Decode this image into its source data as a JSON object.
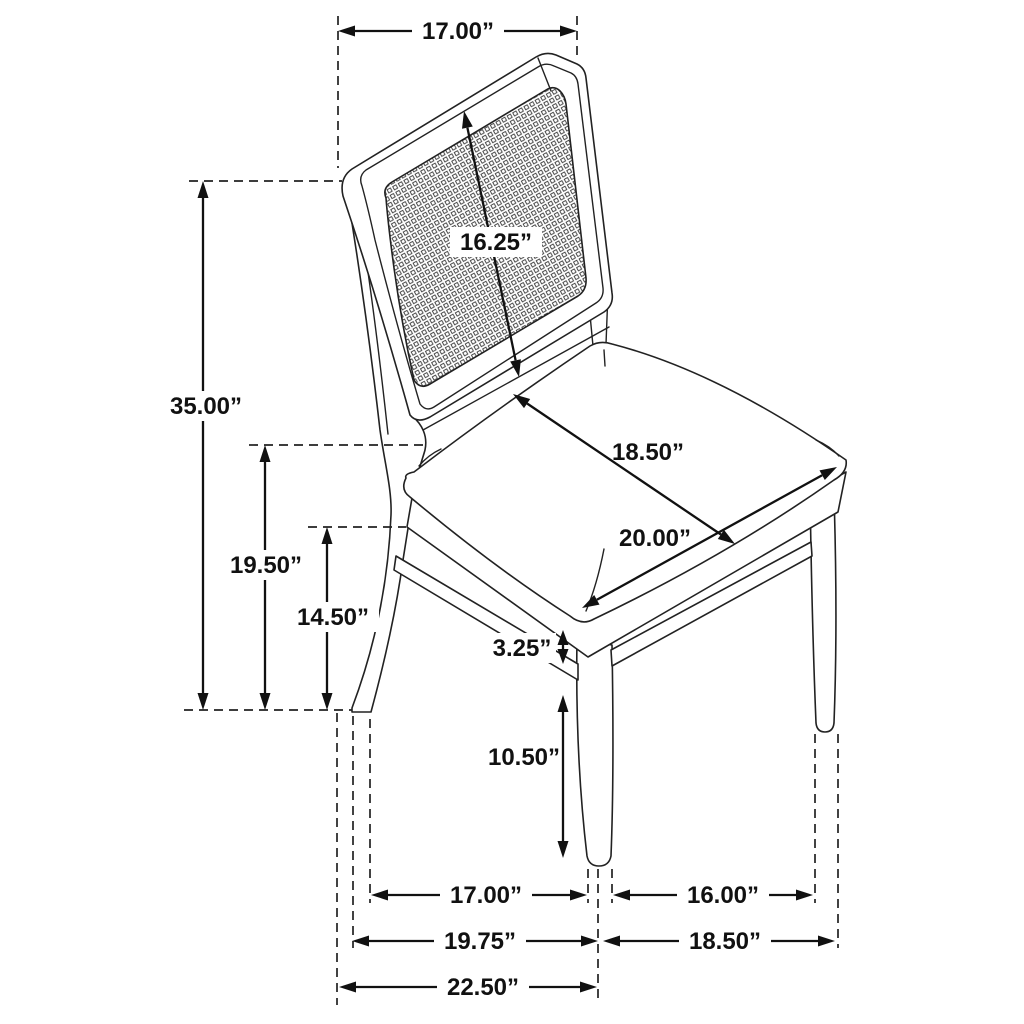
{
  "diagram": {
    "type": "product-dimension-diagram",
    "subject": "dining side chair with cane backrest and upholstered seat",
    "unit": "inches",
    "line_color": "#111111",
    "background_color": "#ffffff",
    "dims": {
      "back_top_width": "17.00”",
      "back_panel_length": "16.25”",
      "overall_height": "35.00”",
      "seat_height": "19.50”",
      "floor_to_apron": "14.50”",
      "seat_width": "18.50”",
      "seat_depth": "20.00”",
      "apron_stretcher_gap": "3.25”",
      "stretcher_floor_clearance": "10.50”",
      "side_leg_spacing": "17.00”",
      "front_leg_spacing": "16.00”",
      "base_depth_to_front_leg": "19.75”",
      "base_front_width": "18.50”",
      "base_overall_depth": "22.50”"
    }
  }
}
